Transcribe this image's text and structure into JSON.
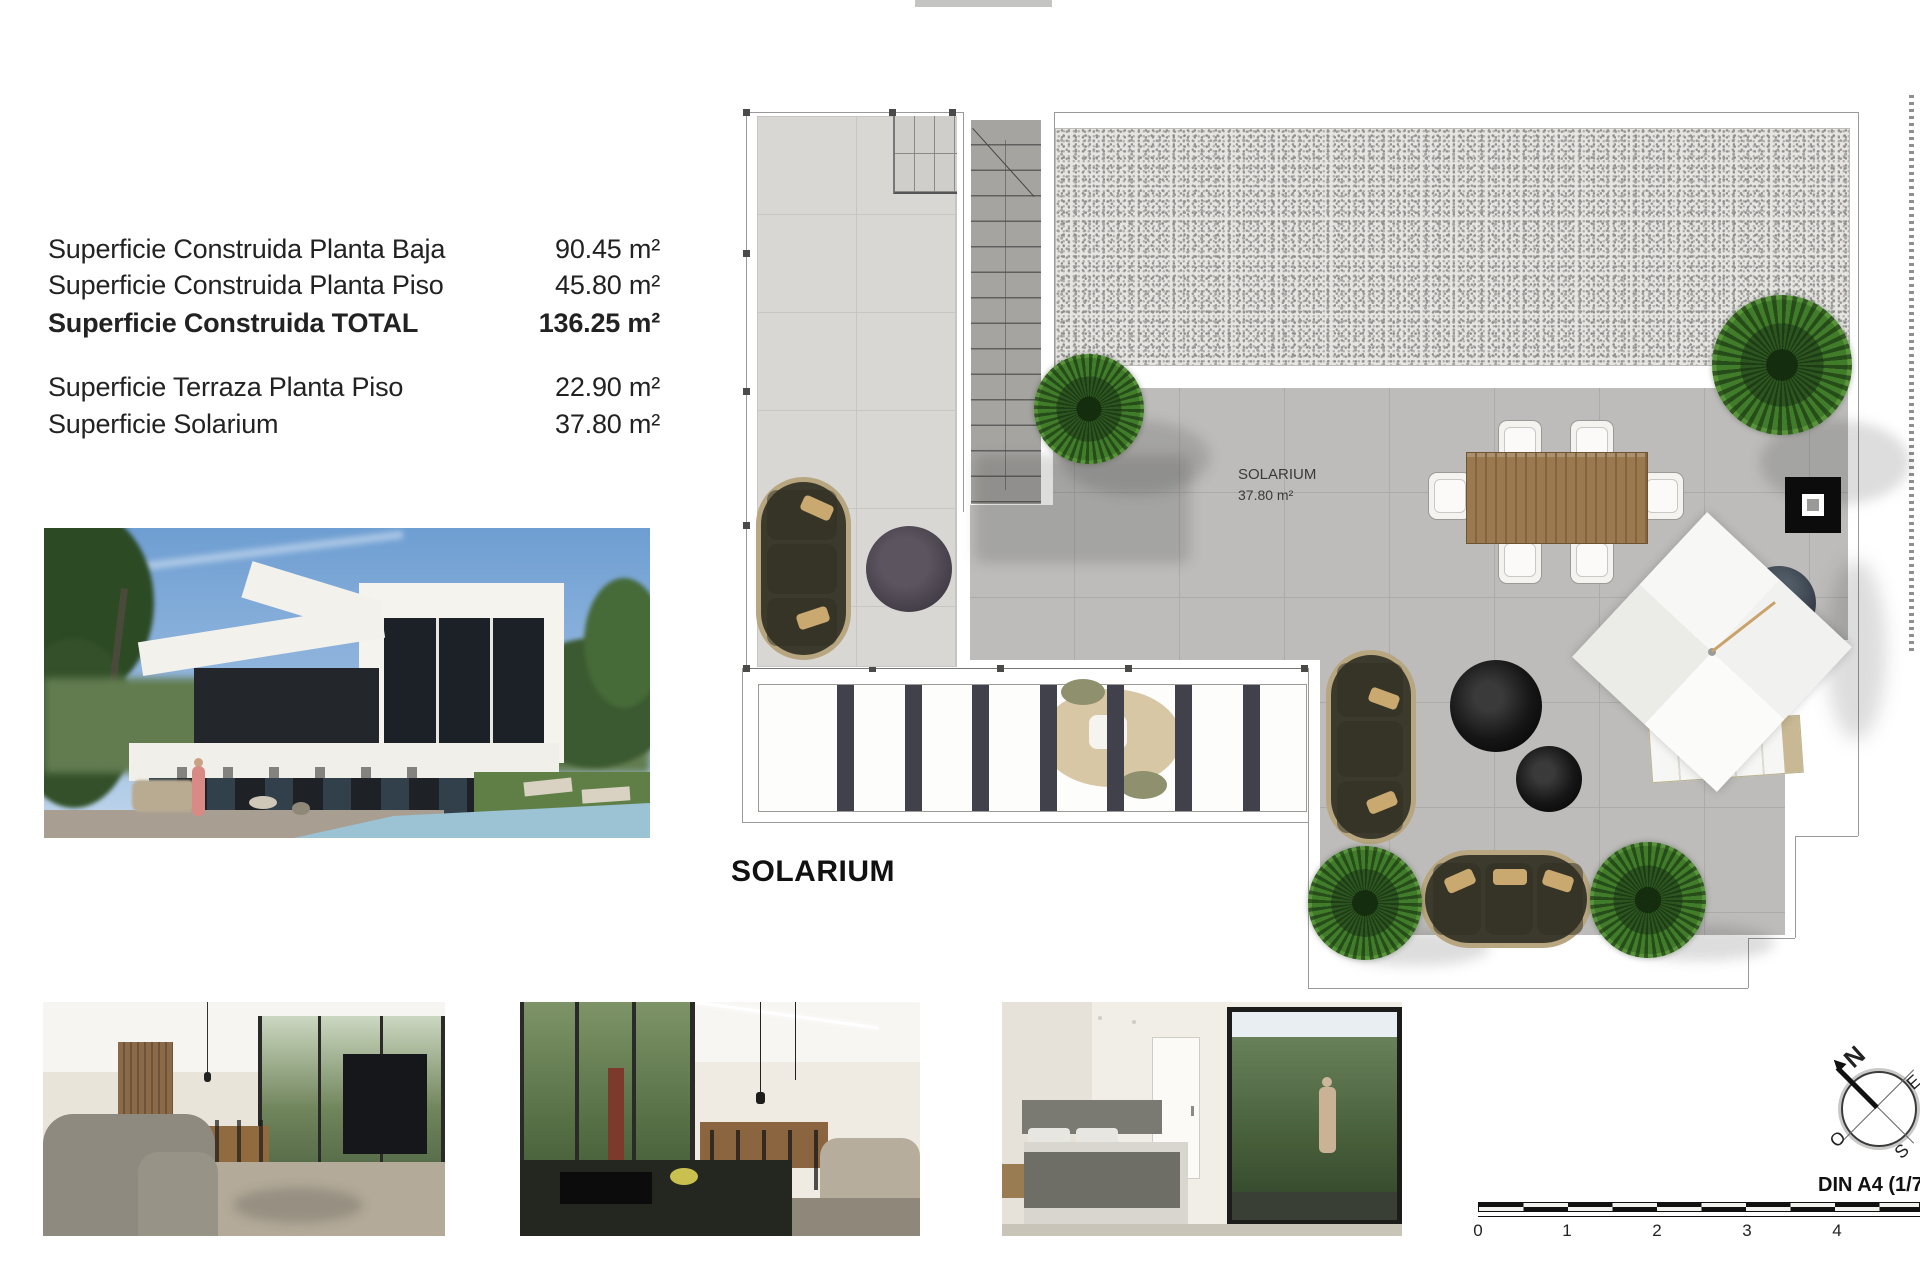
{
  "document": {
    "area_table": {
      "rows": [
        {
          "label": "Superficie Construida Planta Baja",
          "value": "90.45 m²"
        },
        {
          "label": "Superficie Construida Planta Piso",
          "value": "45.80 m²"
        },
        {
          "label": "Superficie Construida TOTAL",
          "value": "136.25 m²"
        },
        {
          "label": "Superficie Terraza Planta Piso",
          "value": "22.90 m²"
        },
        {
          "label": "Superficie Solarium",
          "value": "37.80 m²"
        }
      ]
    },
    "plan": {
      "room_label": "SOLARIUM",
      "room_area": "37.80 m²",
      "caption": "SOLARIUM"
    },
    "scale_bar": {
      "ticks": [
        "0",
        "1",
        "2",
        "3",
        "4"
      ],
      "sheet_label": "DIN A4 (1/75"
    },
    "compass": {
      "n": "N",
      "e": "E",
      "o": "O",
      "s": "S"
    },
    "palette": {
      "tile_light": "#d8d7d4",
      "tile_mid": "#bdbcba",
      "sofa_olive": "#3c3a2c",
      "wood_table": "#9a7950",
      "plant_green": "#417c2b",
      "sky_blue": "#6e9ed2",
      "pool_blue": "#9cc3d4"
    }
  }
}
